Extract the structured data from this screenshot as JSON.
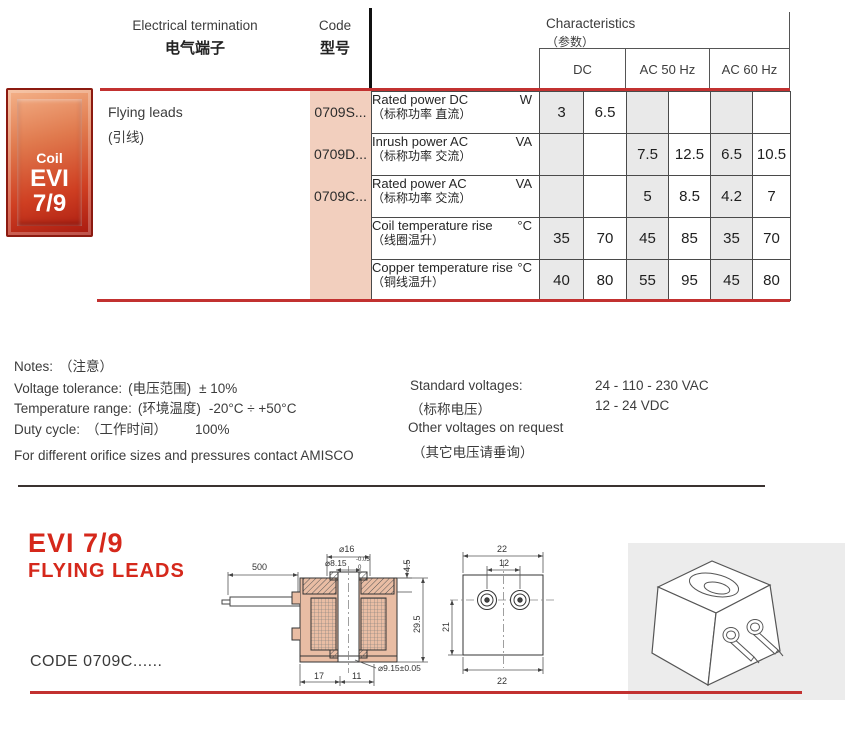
{
  "header": {
    "col1_en": "Electrical termination",
    "col1_zh": "电气端子",
    "col2_en": "Code",
    "col2_zh": "型号",
    "col3_en": "Characteristics",
    "col3_zh": "（参数）",
    "subcols": [
      "DC",
      "AC 50 Hz",
      "AC 60 Hz"
    ]
  },
  "badge": {
    "line1": "Coil",
    "line2": "EVI",
    "line3": "7/9"
  },
  "table": {
    "termination_en": "Flying leads",
    "termination_zh": "(引线)",
    "codes": [
      "0709S...",
      "0709D...",
      "0709C..."
    ],
    "rows": [
      {
        "en": "Rated power DC",
        "zh": "（标称功率 直流）",
        "unit": "W",
        "values": [
          "3",
          "6.5",
          "",
          "",
          "",
          ""
        ]
      },
      {
        "en": "Inrush power AC",
        "zh": "（标称功率 交流）",
        "unit": "VA",
        "values": [
          "",
          "",
          "7.5",
          "12.5",
          "6.5",
          "10.5"
        ]
      },
      {
        "en": "Rated power AC",
        "zh": "（标称功率 交流）",
        "unit": "VA",
        "values": [
          "",
          "",
          "5",
          "8.5",
          "4.2",
          "7"
        ]
      },
      {
        "en": "Coil temperature rise",
        "zh": "（线圈温升）",
        "unit": "°C",
        "values": [
          "35",
          "70",
          "45",
          "85",
          "35",
          "70"
        ]
      },
      {
        "en": "Copper temperature rise",
        "zh": "（铜线温升）",
        "unit": "°C",
        "values": [
          "40",
          "80",
          "55",
          "95",
          "45",
          "80"
        ]
      }
    ]
  },
  "notes": {
    "title_en": "Notes:",
    "title_zh": "（注意）",
    "rows": [
      {
        "label": "Voltage tolerance:",
        "label_zh": "(电压范围)",
        "value": "± 10%"
      },
      {
        "label": "Temperature range:",
        "label_zh": "(环境温度)",
        "value": "-20°C ÷ +50°C"
      },
      {
        "label": "Duty cycle:",
        "label_zh": "（工作时间）",
        "value": "100%"
      }
    ],
    "contact": "For different orifice sizes and pressures contact AMISCO",
    "standard_label": "Standard voltages:",
    "standard_label_zh": "（标称电压）",
    "standard_value1": "24 - 110 - 230 VAC",
    "standard_value2": "12 - 24 VDC",
    "other_label": "Other voltages on request",
    "other_label_zh": "（其它电压请垂询）"
  },
  "section": {
    "title1": "EVI 7/9",
    "title2": "FLYING LEADS",
    "code_caption": "CODE 0709C......"
  },
  "drawings": {
    "dim_500": "500",
    "dim_d16": "⌀16",
    "dim_d815": "⌀8.15",
    "dim_d815_tol_top": "-0.05",
    "dim_d815_tol_bottom": "0",
    "dim_45": "4.5",
    "dim_295": "29.5",
    "dim_d915": "⌀9.15±0.05",
    "dim_17": "17",
    "dim_11": "11",
    "front_top": "22",
    "front_inner": "12",
    "front_left": "21",
    "front_bottom": "22"
  },
  "colors": {
    "accent_red": "#c23130",
    "title_red": "#d5281b",
    "code_column_bg": "#f2cfbe",
    "shaded_cell_bg": "#e9e9e9",
    "panel_bg": "#ececec",
    "drawing_body_fill": "#e9bda4"
  }
}
